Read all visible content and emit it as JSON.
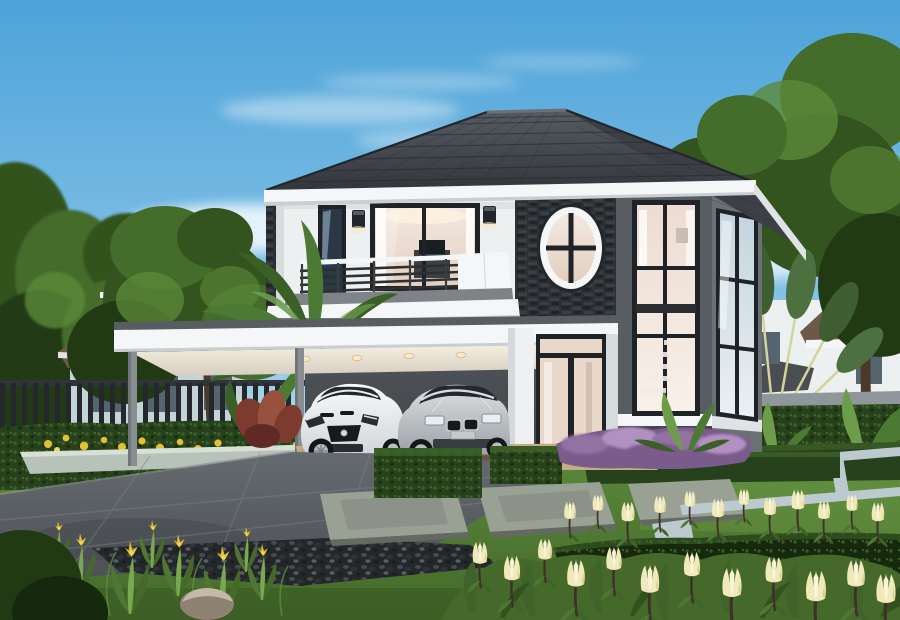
{
  "scene": {
    "type": "architectural-exterior-rendering",
    "description": "Daytime photorealistic rendering of a modern two-storey detached house with a dark hipped tile roof, white and charcoal-grey walls, a dark stone feature wall with an oval window, a balcony with metal railing, and a carport sheltering a white sports coupe and a silver sedan. Landscaped garden with trimmed hedges, stone paver slabs, a grey driveway, purple shrubs, cream tulip-like flowers, yellow flower beds and tropical plants; neighbouring houses and trees in the background under a blue sky with wispy clouds.",
    "time_of_day": "day",
    "objects": [
      {
        "name": "sky",
        "description": "blue sky gradient with wispy white clouds"
      },
      {
        "name": "main-house",
        "description": "two-storey modern house, white upper wall, charcoal right wing"
      },
      {
        "name": "roof",
        "description": "dark grey hipped tile roof with white fascia"
      },
      {
        "name": "oval-window",
        "description": "white-rimmed oval window on dark stone feature wall"
      },
      {
        "name": "master-window",
        "description": "large sliding window with white curtains and warm interior"
      },
      {
        "name": "balcony",
        "description": "balcony with dark metal railing and white parapet"
      },
      {
        "name": "carport",
        "description": "flat-roof carport with warm recessed downlights"
      },
      {
        "name": "tall-corner-windows",
        "description": "double-height corner windows showing an interior staircase"
      },
      {
        "name": "entrance-door",
        "description": "dark-framed glass double door with white pillar"
      },
      {
        "name": "sports-car",
        "description": "white sports coupe parked under carport"
      },
      {
        "name": "sedan-car",
        "description": "silver sedan parked under carport"
      },
      {
        "name": "driveway",
        "description": "grey paved driveway"
      },
      {
        "name": "lawn",
        "description": "green lawn with pale stone edging strips"
      },
      {
        "name": "paver-slabs",
        "description": "rectangular stone stepping slabs"
      },
      {
        "name": "hedges",
        "description": "trimmed box hedges and long hedge rows"
      },
      {
        "name": "purple-shrubs",
        "description": "purple flowering shrubs at house base"
      },
      {
        "name": "cream-flowers",
        "description": "cream tulip-like flowers in foreground"
      },
      {
        "name": "yellow-flowers",
        "description": "yellow flower bed along left hedge"
      },
      {
        "name": "iris-plants",
        "description": "leafy plants with yellow blooms, bottom left"
      },
      {
        "name": "gravel-bed",
        "description": "dark pebble bed beside driveway"
      },
      {
        "name": "rock",
        "description": "garden boulder"
      },
      {
        "name": "banana-plants",
        "description": "large banana leaves left of carport"
      },
      {
        "name": "travelers-palm",
        "description": "fan-shaped travellers palm behind garden wall"
      },
      {
        "name": "neighbor-house-left",
        "description": "pale two-storey neighbour house with brown tile roof behind dark fence"
      },
      {
        "name": "neighbor-house-right",
        "description": "white neighbour house with terracotta roof behind hedge wall"
      },
      {
        "name": "fence",
        "description": "dark vertical-slat boundary fence"
      },
      {
        "name": "trees",
        "description": "large green trees framing both sides"
      }
    ]
  },
  "palette": {
    "sky_top": "#4da3d9",
    "sky_mid": "#8cc6e9",
    "sky_horizon": "#d8ecf4",
    "cloud": "#ffffff",
    "roof_light": "#565c63",
    "roof_dark": "#33373c",
    "roof_side": "#3c4046",
    "roof_edge": "#23262a",
    "ridge": "#6a7076",
    "fascia": "#f4f6f7",
    "fascia_shade": "#dfe3e5",
    "wall_white": "#edf0f1",
    "wall_white_shade": "#d7dcdf",
    "wall_gray": "#585d62",
    "wall_gray_light": "#6b7075",
    "wall_gray_dark": "#44484d",
    "stone": "#2d3034",
    "stone_hi": "#3d4146",
    "stone_lo": "#1f2225",
    "frame": "#1f2327",
    "glass_warm_a": "#f3e8e0",
    "glass_warm_b": "#e3cfc1",
    "glass_tall_a": "#eddcd3",
    "glass_tall_b": "#f8f0e9",
    "glass_cool_a": "#c4d4dd",
    "glass_cool_b": "#eaf0f3",
    "glass_dark": "#2b3947",
    "sky_reflect": "#9fc0d4",
    "sconce": "#22262a",
    "glow": "#f7e7c3",
    "balcony_gray": "#7e8387",
    "recess_gray": "#707478",
    "ceiling_a": "#f6f0e3",
    "ceiling_b": "#d5cec0",
    "downlight": "#ffe9c0",
    "post_gray": "#878d91",
    "interior_dark": "#3c4044",
    "interior_mid": "#55595d",
    "door_glass": "#e9d7ca",
    "pillar_white": "#eef0f1",
    "pillar_shade": "#d5d9dc",
    "drive_a": "#666b6f",
    "drive_b": "#4c5054",
    "drive_line": "#7b8186",
    "drive_dark": "#43474b",
    "carport_floor": "#c4ac84",
    "floor_line": "#a5906c",
    "gravel_base": "#24272a",
    "grass_a": "#5e8c3e",
    "grass_b": "#44692a",
    "grass_hi": "#79a94e",
    "grass_lo": "#33511f",
    "hedge_base": "#26411b",
    "hedge_hi": "#3f6329",
    "hedge_lo": "#16280e",
    "tree_a": "#33531f",
    "tree_b": "#446c2b",
    "tree_c": "#5d8a39",
    "tree_lo": "#223a14",
    "trunk": "#4b3a2a",
    "palm_stem": "#d3d39a",
    "palm_leaf": "#3e5d31",
    "palm_leaf2": "#4c7040",
    "banana_a": "#4c7a35",
    "banana_b": "#3a6028",
    "banana_c": "#6d9c4b",
    "purple_a": "#9272a3",
    "purple_b": "#b091c1",
    "purple_c": "#7b5a8c",
    "red_leaf": "#7d3b30",
    "red_leaf2": "#96513f",
    "cream": "#f0e9ba",
    "cream_hi": "#faf5d8",
    "cream_lo": "#d9cd90",
    "stem_dark": "#40302a",
    "yellow": "#e2bf33",
    "yellow_hi": "#f0d65c",
    "iris_green": "#4f7733",
    "slab": "#99a094",
    "slab_lo": "#777d72",
    "slab_edge": "#646a60",
    "edging": "#bcc9cf",
    "curb": "#b7c2b8",
    "curb_hi": "#d6e0d5",
    "rock_a": "#c6b9a5",
    "rock_b": "#8e8373",
    "fence": "#24282c",
    "fence_rail": "#31353a",
    "bg_wall": "#dde9ea",
    "bg_wall_lo": "#c3d3d6",
    "bg_roof": "#6e5848",
    "bg_roof_hi": "#8a6f5a",
    "bg_win": "#55646e",
    "bg_roof2": "#4a4e52",
    "car_white_a": "#f8fafb",
    "car_white_b": "#cfd4d8",
    "car_white_lo": "#aab0b5",
    "car_silver_a": "#dce0e3",
    "car_silver_b": "#9a9fa3",
    "car_silver_lo": "#75797d",
    "car_glass": "#24282c",
    "car_glass_hi": "#8fa6b5",
    "car_detail": "#17191c",
    "chrome": "#d6dbde",
    "wheel": "#b8bdc1",
    "tire": "#141619",
    "shadow": "#14171a"
  }
}
